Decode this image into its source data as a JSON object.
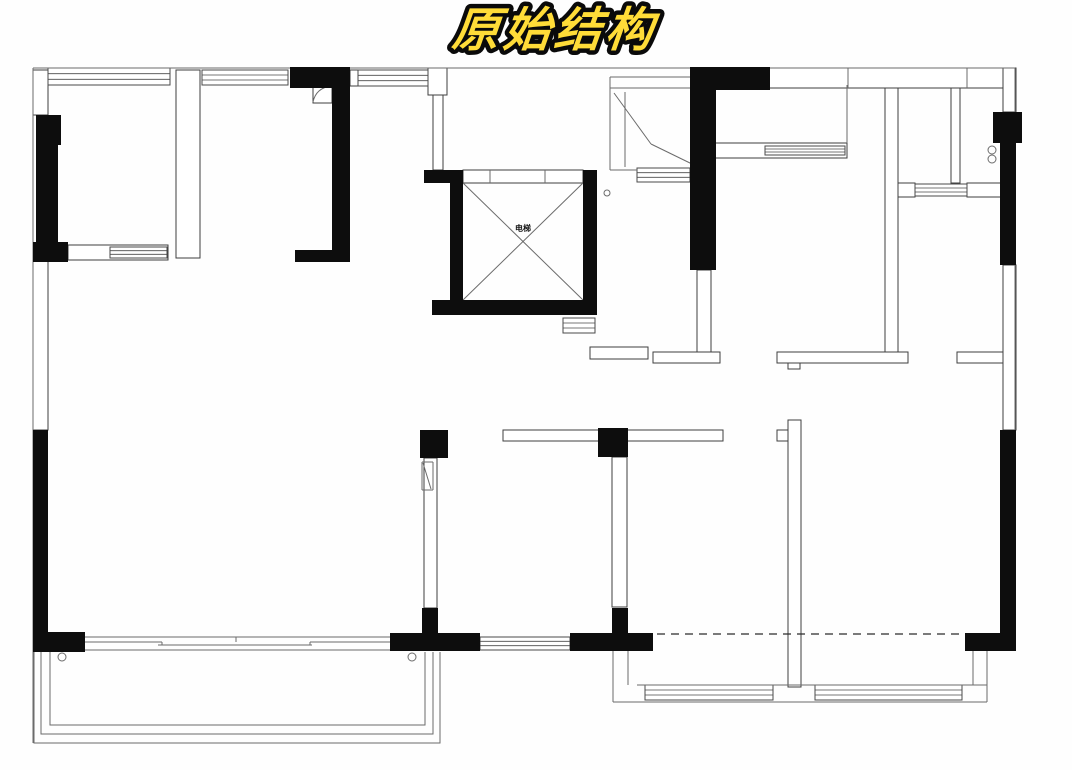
{
  "title": {
    "text": "原始结构",
    "fill": "#ffdc38",
    "outline": "#0a0a0a"
  },
  "plan": {
    "elevator_label": "电梯",
    "colors": {
      "wall": "#0d0d0d",
      "thin": "#3f3f3f",
      "line": "#6b6b6b",
      "window": "#4a4a4a",
      "dash": "#2b2b2b",
      "fill": "#ffffff"
    },
    "black_walls": [
      [
        36,
        115,
        25,
        30
      ],
      [
        36,
        145,
        22,
        113
      ],
      [
        33,
        242,
        35,
        20
      ],
      [
        290,
        67,
        60,
        21
      ],
      [
        332,
        85,
        18,
        173
      ],
      [
        295,
        250,
        55,
        12
      ],
      [
        424,
        170,
        39,
        13
      ],
      [
        450,
        183,
        13,
        120
      ],
      [
        432,
        300,
        165,
        15
      ],
      [
        583,
        170,
        14,
        145
      ],
      [
        690,
        67,
        80,
        23
      ],
      [
        690,
        90,
        26,
        180
      ],
      [
        993,
        112,
        29,
        31
      ],
      [
        1000,
        143,
        16,
        122
      ],
      [
        1000,
        430,
        16,
        221
      ],
      [
        965,
        633,
        51,
        18
      ],
      [
        420,
        430,
        28,
        28
      ],
      [
        598,
        428,
        30,
        29
      ],
      [
        390,
        633,
        90,
        18
      ],
      [
        422,
        608,
        16,
        25
      ],
      [
        570,
        633,
        83,
        18
      ],
      [
        612,
        608,
        16,
        25
      ],
      [
        33,
        430,
        15,
        202
      ],
      [
        33,
        632,
        52,
        20
      ]
    ],
    "thin_walls": [
      [
        33,
        70,
        15,
        45
      ],
      [
        33,
        260,
        15,
        170
      ],
      [
        176,
        70,
        24,
        188
      ],
      [
        68,
        245,
        100,
        15
      ],
      [
        350,
        70,
        9,
        16
      ],
      [
        428,
        68,
        19,
        27
      ],
      [
        433,
        95,
        10,
        75
      ],
      [
        463,
        170,
        120,
        13
      ],
      [
        590,
        347,
        58,
        12
      ],
      [
        697,
        270,
        14,
        82
      ],
      [
        653,
        352,
        67,
        11
      ],
      [
        715,
        143,
        132,
        15
      ],
      [
        885,
        85,
        13,
        267
      ],
      [
        777,
        352,
        131,
        11
      ],
      [
        957,
        352,
        46,
        11
      ],
      [
        898,
        183,
        17,
        14
      ],
      [
        967,
        183,
        36,
        14
      ],
      [
        951,
        88,
        9,
        95
      ],
      [
        757,
        68,
        258,
        20
      ],
      [
        1003,
        68,
        13,
        44
      ],
      [
        1003,
        265,
        13,
        165
      ],
      [
        503,
        430,
        220,
        11
      ],
      [
        424,
        458,
        13,
        150
      ],
      [
        612,
        457,
        15,
        150
      ],
      [
        788,
        420,
        13,
        267
      ],
      [
        777,
        430,
        11,
        11
      ],
      [
        313,
        85,
        19,
        18
      ],
      [
        788,
        363,
        12,
        6
      ]
    ],
    "windows": [
      [
        48,
        68,
        122,
        17
      ],
      [
        202,
        70,
        86,
        15
      ],
      [
        358,
        70,
        70,
        16
      ],
      [
        110,
        247,
        57,
        11
      ],
      [
        765,
        146,
        80,
        9
      ],
      [
        915,
        184,
        52,
        12
      ],
      [
        563,
        318,
        32,
        15
      ],
      [
        637,
        168,
        53,
        14
      ],
      [
        480,
        637,
        90,
        13
      ],
      [
        645,
        685,
        128,
        15
      ],
      [
        815,
        685,
        147,
        15
      ]
    ],
    "lines": [
      [
        33,
        68,
        1015,
        68
      ],
      [
        33,
        68,
        33,
        743
      ],
      [
        1015,
        68,
        1015,
        651
      ],
      [
        848,
        68,
        848,
        88
      ],
      [
        967,
        68,
        967,
        88
      ],
      [
        847,
        85,
        847,
        143
      ],
      [
        610,
        77,
        690,
        77
      ],
      [
        610,
        77,
        610,
        170
      ],
      [
        610,
        170,
        637,
        170
      ],
      [
        610,
        88,
        690,
        88
      ],
      [
        625,
        92,
        625,
        167
      ],
      [
        614,
        93,
        651,
        144
      ],
      [
        651,
        144,
        692,
        164
      ],
      [
        490,
        170,
        490,
        183
      ],
      [
        545,
        170,
        545,
        183
      ],
      [
        463,
        183,
        583,
        300
      ],
      [
        583,
        183,
        463,
        300
      ],
      [
        422,
        462,
        433,
        462
      ],
      [
        422,
        462,
        422,
        490
      ],
      [
        433,
        462,
        433,
        490
      ],
      [
        422,
        490,
        433,
        490
      ],
      [
        423,
        463,
        431,
        489
      ],
      [
        85,
        637,
        390,
        637
      ],
      [
        85,
        650,
        390,
        650
      ],
      [
        85,
        642,
        162,
        642
      ],
      [
        158,
        645,
        312,
        645
      ],
      [
        310,
        642,
        390,
        642
      ],
      [
        162,
        642,
        162,
        645
      ],
      [
        310,
        642,
        310,
        645
      ],
      [
        236,
        637,
        236,
        642
      ],
      [
        613,
        651,
        613,
        702
      ],
      [
        613,
        702,
        987,
        702
      ],
      [
        987,
        651,
        987,
        702
      ],
      [
        628,
        651,
        628,
        685
      ],
      [
        973,
        651,
        973,
        685
      ],
      [
        637,
        685,
        987,
        685
      ]
    ],
    "dashed_lines": [
      [
        657,
        634,
        965,
        634
      ]
    ],
    "circles": [
      [
        52,
        152,
        4
      ],
      [
        52,
        163,
        4
      ],
      [
        992,
        150,
        4
      ],
      [
        992,
        159,
        4
      ],
      [
        62,
        657,
        4
      ],
      [
        412,
        657,
        4
      ],
      [
        607,
        193,
        3
      ]
    ],
    "polylines": [
      [
        [
          34,
          652
        ],
        [
          34,
          743
        ],
        [
          440,
          743
        ],
        [
          440,
          652
        ]
      ],
      [
        [
          41,
          652
        ],
        [
          41,
          734
        ],
        [
          433,
          734
        ],
        [
          433,
          652
        ]
      ],
      [
        [
          50,
          652
        ],
        [
          50,
          725
        ],
        [
          425,
          725
        ],
        [
          425,
          652
        ]
      ]
    ],
    "arcs": [
      "M313,102 Q316,88 331,86"
    ],
    "elevator_label_pos": [
      523,
      231
    ],
    "title_pos": [
      553,
      46
    ]
  }
}
